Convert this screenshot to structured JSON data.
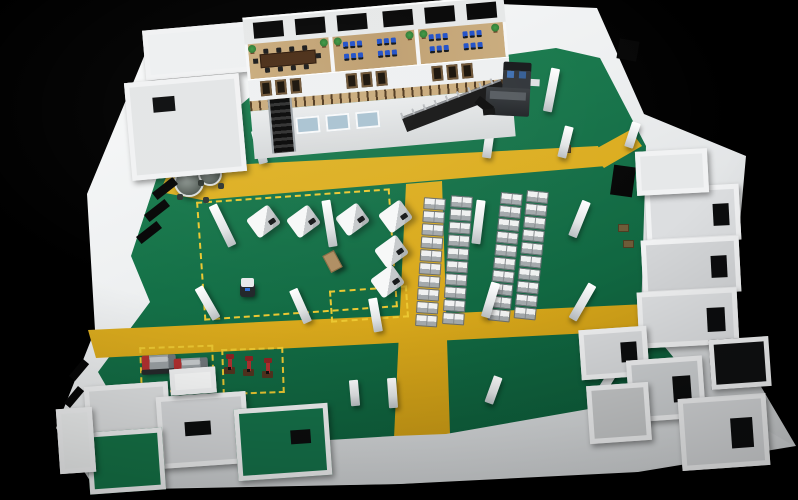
{
  "scene": {
    "type": "3d-factory-floorplan-render",
    "palette": {
      "wall": "#f1f2f3",
      "wallShade": "#d7d9db",
      "wallDim": "#c3c6c8",
      "green1": "#1f8b55",
      "green2": "#147047",
      "green3": "#0a5434",
      "yellow1": "#e6bd2f",
      "yellow2": "#d9a91c",
      "yellow3": "#c2920f",
      "dash": "#ecc832",
      "wood": "#c9ab7c",
      "woodDark": "#a8895c",
      "tableBrown": "#4a2d16",
      "monitorBlue": "#2050c8",
      "winDark": "#171007",
      "winFrame": "#6e5435",
      "glassBlue": "#a9c2d1",
      "steel": "#8d9296",
      "red": "#b23030",
      "dark": "#1c1e20",
      "plant": "#2f7a33",
      "stair": "#141414"
    },
    "pillars": [
      {
        "x": 218,
        "y": 203,
        "h": 45,
        "r": -26
      },
      {
        "x": 203,
        "y": 285,
        "h": 36,
        "r": -30
      },
      {
        "x": 296,
        "y": 288,
        "h": 36,
        "r": -24
      },
      {
        "x": 325,
        "y": 200,
        "h": 47,
        "r": -9
      },
      {
        "x": 371,
        "y": 298,
        "h": 34,
        "r": -10
      },
      {
        "x": 388,
        "y": 378,
        "h": 30,
        "r": -4
      },
      {
        "x": 474,
        "y": 200,
        "h": 44,
        "r": 7
      },
      {
        "x": 486,
        "y": 282,
        "h": 36,
        "r": 17
      },
      {
        "x": 489,
        "y": 376,
        "h": 28,
        "r": 20
      },
      {
        "x": 575,
        "y": 200,
        "h": 38,
        "r": 22
      },
      {
        "x": 578,
        "y": 282,
        "h": 40,
        "r": 30
      },
      {
        "x": 602,
        "y": 368,
        "h": 30,
        "r": 32
      },
      {
        "x": 474,
        "y": 70,
        "h": 47,
        "r": 6
      },
      {
        "x": 547,
        "y": 68,
        "h": 44,
        "r": 11
      },
      {
        "x": 561,
        "y": 126,
        "h": 32,
        "r": 14
      },
      {
        "x": 484,
        "y": 128,
        "h": 30,
        "r": 8
      },
      {
        "x": 298,
        "y": 108,
        "h": 38,
        "r": -10
      },
      {
        "x": 255,
        "y": 130,
        "h": 34,
        "r": -14
      },
      {
        "x": 350,
        "y": 380,
        "h": 26,
        "r": -5
      },
      {
        "x": 628,
        "y": 122,
        "h": 26,
        "r": 18
      }
    ],
    "machine_columns": [
      {
        "x": 424,
        "y": 198,
        "count": 10,
        "r": 4
      },
      {
        "x": 451,
        "y": 196,
        "count": 10,
        "r": 4
      },
      {
        "x": 501,
        "y": 193,
        "count": 10,
        "r": 6
      },
      {
        "x": 527,
        "y": 191,
        "count": 10,
        "r": 6
      }
    ],
    "work_machines": [
      {
        "x": 250,
        "y": 210,
        "r": -36
      },
      {
        "x": 290,
        "y": 210,
        "r": -36
      },
      {
        "x": 339,
        "y": 208,
        "r": -36
      },
      {
        "x": 382,
        "y": 205,
        "r": -36
      },
      {
        "x": 378,
        "y": 240,
        "r": -36
      },
      {
        "x": 374,
        "y": 270,
        "r": -36
      }
    ],
    "dashed_zones": [
      {
        "x": 200,
        "y": 195,
        "w": 190,
        "h": 115,
        "r": -4
      },
      {
        "x": 330,
        "y": 288,
        "w": 74,
        "h": 28,
        "r": -4
      },
      {
        "x": 140,
        "y": 346,
        "w": 70,
        "h": 42,
        "r": -2
      },
      {
        "x": 222,
        "y": 348,
        "w": 58,
        "h": 42,
        "r": -2
      }
    ],
    "lathes": [
      {
        "x": 142,
        "y": 355
      },
      {
        "x": 174,
        "y": 358
      }
    ],
    "drill_presses": [
      {
        "x": 224,
        "y": 358
      },
      {
        "x": 243,
        "y": 360
      },
      {
        "x": 262,
        "y": 362
      }
    ],
    "round_tables": [
      {
        "x": 174,
        "y": 167,
        "d": 26
      },
      {
        "x": 198,
        "y": 162,
        "d": 20
      }
    ],
    "agv": {
      "x": 240,
      "y": 278
    },
    "crate": {
      "x": 326,
      "y": 252
    },
    "pallets": [
      {
        "x": 560,
        "y": 145,
        "w": 9,
        "h": 6
      },
      {
        "x": 618,
        "y": 224,
        "w": 9,
        "h": 6
      },
      {
        "x": 623,
        "y": 240,
        "w": 9,
        "h": 6
      }
    ],
    "office": {
      "rooms": 3,
      "back_windows": 6,
      "fascia_window_groups": 3,
      "panes_per_group": 3,
      "ground_windows": 3,
      "conference_chairs": 10,
      "workstation_clusters": 4,
      "monitors_per_cluster": 6,
      "plants": 6,
      "staircases": 2,
      "partitions_x": [
        84,
        170
      ],
      "back_window_x": [
        10,
        52,
        94,
        140,
        182,
        224
      ],
      "fascia_group_x": [
        12,
        98,
        184
      ],
      "ground_window_x": [
        44,
        74,
        104
      ],
      "plant_x": [
        4,
        76,
        90,
        162,
        176,
        248
      ],
      "cluster_x": [
        98,
        132,
        184,
        218
      ]
    },
    "wall_windows": [
      {
        "x": 152,
        "y": 184,
        "w": 26,
        "h": 9,
        "r": -38
      },
      {
        "x": 144,
        "y": 206,
        "w": 26,
        "h": 9,
        "r": -38
      },
      {
        "x": 136,
        "y": 228,
        "w": 26,
        "h": 9,
        "r": -38
      },
      {
        "x": 68,
        "y": 366,
        "w": 22,
        "h": 8,
        "r": -50
      },
      {
        "x": 63,
        "y": 393,
        "w": 22,
        "h": 8,
        "r": -50
      },
      {
        "x": 66,
        "y": 430,
        "w": 20,
        "h": 8,
        "r": -50
      },
      {
        "x": 148,
        "y": 90,
        "w": 16,
        "h": 18,
        "r": -30
      },
      {
        "x": 140,
        "y": 114,
        "w": 14,
        "h": 15,
        "r": -30
      },
      {
        "x": 618,
        "y": 40,
        "w": 20,
        "h": 20,
        "r": 10
      },
      {
        "x": 612,
        "y": 166,
        "w": 22,
        "h": 30,
        "r": 8
      }
    ],
    "rooms_top_left": [
      {
        "x": 144,
        "y": 26,
        "w": 96,
        "h": 40,
        "floor": "#eef0f1",
        "r": -5
      },
      {
        "x": 128,
        "y": 78,
        "w": 105,
        "h": 88,
        "floor": "#e3e5e6",
        "r": -5,
        "open": {
          "x": 22,
          "y": 12,
          "w": 22,
          "h": 15
        }
      }
    ],
    "rooms_right": [
      {
        "x": 646,
        "y": 186,
        "w": 84,
        "h": 46,
        "floor": "#dcdee0",
        "r": -3,
        "open": {
          "x": 62,
          "y": 14,
          "w": 16,
          "h": 22
        }
      },
      {
        "x": 642,
        "y": 238,
        "w": 88,
        "h": 46,
        "floor": "#d4d6d8",
        "r": -3,
        "open": {
          "x": 64,
          "y": 14,
          "w": 16,
          "h": 22
        }
      },
      {
        "x": 638,
        "y": 290,
        "w": 90,
        "h": 46,
        "floor": "#dddfe1",
        "r": -3,
        "open": {
          "x": 64,
          "y": 14,
          "w": 18,
          "h": 24
        }
      },
      {
        "x": 636,
        "y": 150,
        "w": 62,
        "h": 34,
        "floor": "#e6e8e9",
        "r": -3
      }
    ],
    "rooms_bottom_left": [
      {
        "x": 86,
        "y": 384,
        "w": 74,
        "h": 58,
        "floor": "#dfe1e2",
        "r": -4
      },
      {
        "x": 158,
        "y": 394,
        "w": 80,
        "h": 62,
        "floor": "#d8dadc",
        "r": -4,
        "open": {
          "x": 22,
          "y": 22,
          "w": 26,
          "h": 14
        }
      },
      {
        "x": 236,
        "y": 406,
        "w": 84,
        "h": 62,
        "floor": "#15724a",
        "r": -4,
        "open": {
          "x": 50,
          "y": 20,
          "w": 20,
          "h": 14
        }
      },
      {
        "x": 88,
        "y": 430,
        "w": 66,
        "h": 52,
        "floor": "#157347",
        "r": -4
      },
      {
        "x": 58,
        "y": 408,
        "w": 26,
        "h": 55,
        "floor": "#eef0f0",
        "r": -4
      },
      {
        "x": 170,
        "y": 368,
        "w": 36,
        "h": 16,
        "floor": "#fafbfb",
        "r": -4
      }
    ],
    "rooms_bottom_right": [
      {
        "x": 580,
        "y": 328,
        "w": 58,
        "h": 40,
        "floor": "#d9dbdd",
        "r": -4,
        "open": {
          "x": 36,
          "y": 10,
          "w": 16,
          "h": 20
        }
      },
      {
        "x": 628,
        "y": 358,
        "w": 66,
        "h": 52,
        "floor": "#cfd2d4",
        "r": -4,
        "open": {
          "x": 40,
          "y": 14,
          "w": 18,
          "h": 26
        }
      },
      {
        "x": 680,
        "y": 396,
        "w": 78,
        "h": 62,
        "floor": "#d6d8da",
        "r": -4,
        "open": {
          "x": 46,
          "y": 18,
          "w": 22,
          "h": 30
        }
      },
      {
        "x": 588,
        "y": 384,
        "w": 52,
        "h": 48,
        "floor": "#c8cacb",
        "r": -4
      },
      {
        "x": 710,
        "y": 338,
        "w": 50,
        "h": 40,
        "floor": "#0f1011",
        "r": -4
      }
    ]
  }
}
